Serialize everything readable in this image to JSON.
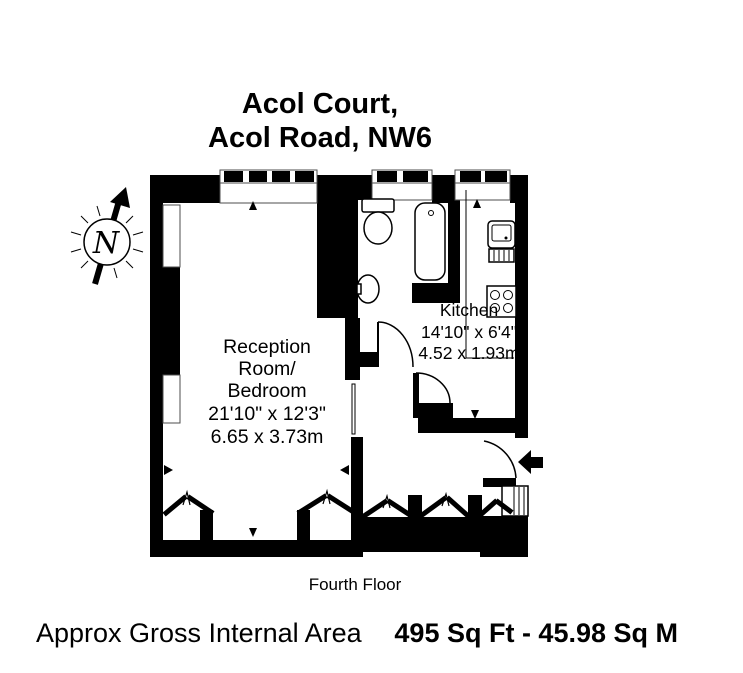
{
  "title": {
    "line1": "Acol Court,",
    "line2": "Acol Road, NW6"
  },
  "compass": {
    "label": "N"
  },
  "rooms": {
    "reception": {
      "lines": [
        "Reception",
        "Room/",
        "Bedroom",
        "21'10\" x 12'3\"",
        "6.65 x 3.73m"
      ]
    },
    "kitchen": {
      "lines": [
        "Kitchen",
        "14'10\" x 6'4\"",
        "4.52 x 1.93m"
      ]
    }
  },
  "floor_label": "Fourth Floor",
  "footer": {
    "area_label": "Approx Gross Internal Area",
    "area_value": "495 Sq Ft  -  45.98 Sq M"
  },
  "colors": {
    "wall": "#000000",
    "background": "#ffffff",
    "text": "#000000"
  }
}
